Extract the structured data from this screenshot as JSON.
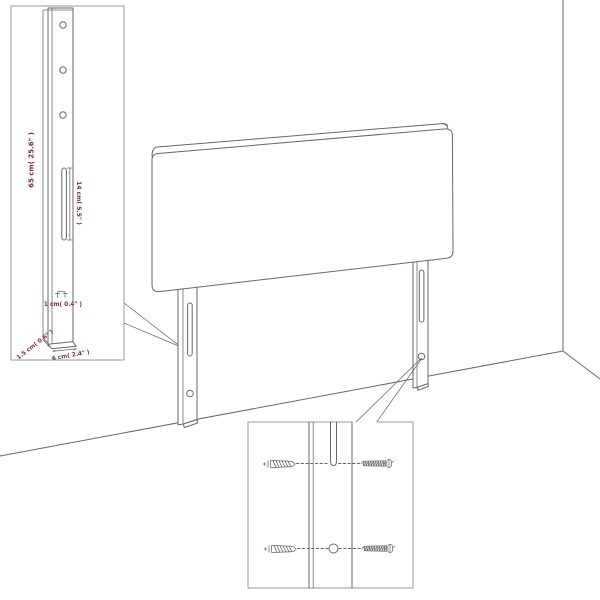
{
  "page": {
    "title": "Headboard wall-mounting assembly diagram",
    "background_color": "#ffffff"
  },
  "colors": {
    "line": "#686868",
    "inset_border": "#9a9a9a",
    "dimension_text": "#772d52"
  },
  "insets": {
    "leg_detail": {
      "dimensions": {
        "leg_height": "65 cm( 25.6\" )",
        "slot_length": "14 cm( 5.5\" )",
        "slot_width": "1 cm( 0.4\" )",
        "leg_depth": "1.5 cm( 0.6\" )",
        "leg_width": "6 cm( 2.4\" )"
      },
      "hole_count": 3
    },
    "mounting_detail": {
      "wall_plug_count": 2,
      "screw_count": 2,
      "icons": {
        "wall_plug": "wall-plug-icon",
        "screw": "screw-icon"
      }
    }
  }
}
